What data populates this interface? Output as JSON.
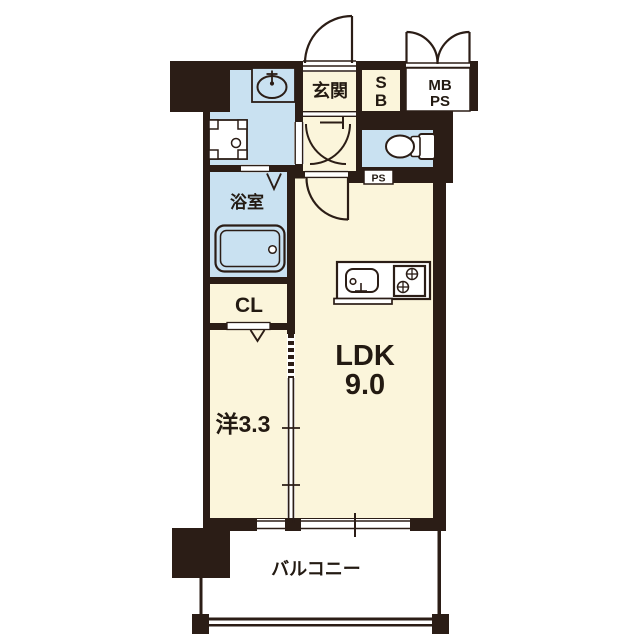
{
  "plan": {
    "title": "apartment-floor-plan",
    "rooms": {
      "genkan": "玄関",
      "shoe_box_top": "S",
      "shoe_box_bottom": "B",
      "meter_box_line1": "MB",
      "meter_box_line2": "PS",
      "pipe_space": "PS",
      "bathroom": "浴室",
      "closet": "CL",
      "western_room": "洋3.3",
      "ldk_name": "LDK",
      "ldk_size": "9.0",
      "balcony": "バルコニー"
    },
    "colors": {
      "wall": "#2B1D16",
      "room_cream": "#FBF5DB",
      "room_blue": "#C9E1F1",
      "background": "#FFFFFF"
    }
  }
}
